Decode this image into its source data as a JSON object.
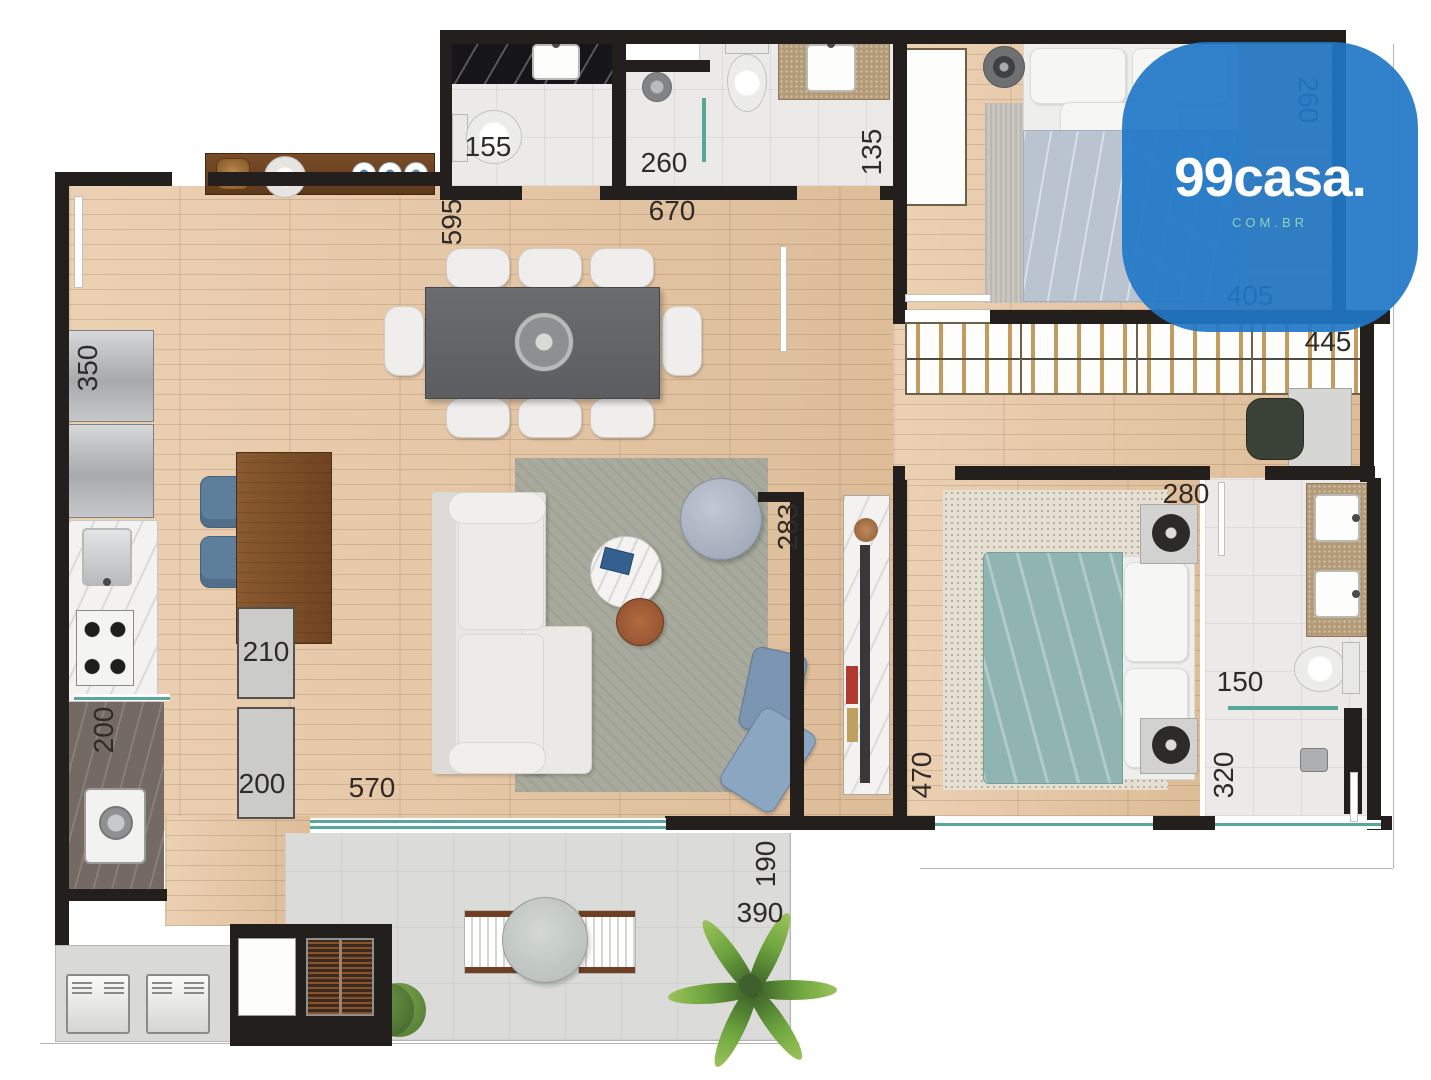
{
  "logo": {
    "brand": "99casa.",
    "domain": "COM.BR",
    "bg_color": "#2176c7",
    "brand_color": "#ffffff",
    "domain_color": "#8fd0bf"
  },
  "dimensions": [
    {
      "text": "155",
      "x": 488,
      "y": 147,
      "rot": 0
    },
    {
      "text": "260",
      "x": 664,
      "y": 163,
      "rot": 0
    },
    {
      "text": "135",
      "x": 872,
      "y": 152,
      "rot": -90
    },
    {
      "text": "670",
      "x": 672,
      "y": 211,
      "rot": 0
    },
    {
      "text": "595",
      "x": 452,
      "y": 222,
      "rot": -90
    },
    {
      "text": "260",
      "x": 1308,
      "y": 100,
      "rot": 90
    },
    {
      "text": "405",
      "x": 1250,
      "y": 296,
      "rot": 0
    },
    {
      "text": "445",
      "x": 1328,
      "y": 342,
      "rot": 0
    },
    {
      "text": "350",
      "x": 88,
      "y": 368,
      "rot": -90
    },
    {
      "text": "283",
      "x": 788,
      "y": 527,
      "rot": -90
    },
    {
      "text": "280",
      "x": 1186,
      "y": 494,
      "rot": 0
    },
    {
      "text": "210",
      "x": 266,
      "y": 652,
      "rot": 0
    },
    {
      "text": "200",
      "x": 262,
      "y": 784,
      "rot": 0
    },
    {
      "text": "200",
      "x": 104,
      "y": 730,
      "rot": -90
    },
    {
      "text": "570",
      "x": 372,
      "y": 788,
      "rot": 0
    },
    {
      "text": "470",
      "x": 922,
      "y": 775,
      "rot": -90
    },
    {
      "text": "150",
      "x": 1240,
      "y": 682,
      "rot": 0
    },
    {
      "text": "320",
      "x": 1224,
      "y": 775,
      "rot": -90
    },
    {
      "text": "190",
      "x": 766,
      "y": 864,
      "rot": -90
    },
    {
      "text": "390",
      "x": 760,
      "y": 913,
      "rot": 0
    }
  ],
  "palette": {
    "wall": "#221f1d",
    "wood_floor": "#e6c49e",
    "teal_glass": "#58a79d",
    "living_rug": "#a7aa9c",
    "bedroom1_duvet": "#bac4d1",
    "bedroom2_duvet": "#8fb4b1",
    "bedroom2_rug": "#e6e0d2",
    "island_wood": "#7d4f28",
    "stool_blue": "#5d7f9c",
    "logo_blue": "#2176c7"
  }
}
